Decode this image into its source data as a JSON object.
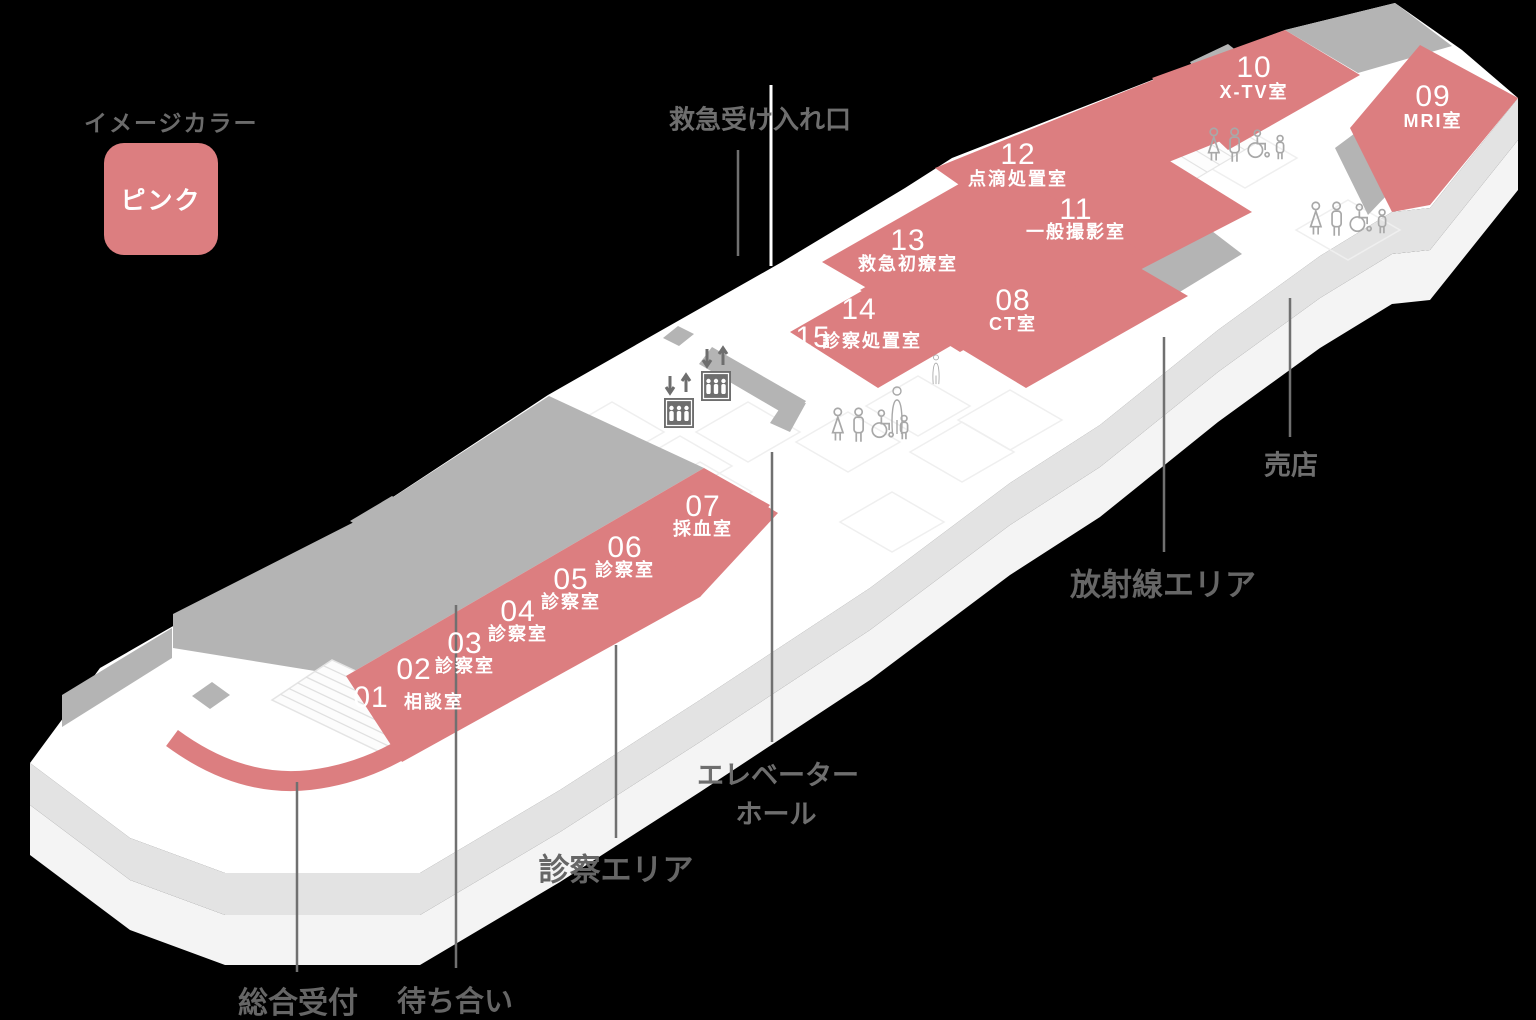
{
  "legend": {
    "title": "イメージカラー",
    "swatch_label": "ピンク"
  },
  "colors": {
    "pink": "#DC7E80",
    "zone_gray": "#B4B4B4",
    "floor_side": "#E3E3E3",
    "floor_side_lower": "#F4F4F4",
    "label_gray": "#666666",
    "icon_gray": "#6E6E6E"
  },
  "labels": {
    "emergency_entrance": "救急受け入れ口",
    "reception": "総合受付",
    "waiting": "待ち合い",
    "exam_area": "診察エリア",
    "elevator_hall_1": "エレベーター",
    "elevator_hall_2": "ホール",
    "radiation_area": "放射線エリア",
    "shop": "売店"
  },
  "rooms": [
    {
      "number": "01",
      "name": "相談室"
    },
    {
      "number": "02",
      "name": ""
    },
    {
      "number": "03",
      "name": "診察室"
    },
    {
      "number": "04",
      "name": "診察室"
    },
    {
      "number": "05",
      "name": "診察室"
    },
    {
      "number": "06",
      "name": "診察室"
    },
    {
      "number": "07",
      "name": "採血室"
    },
    {
      "number": "08",
      "name": "CT室"
    },
    {
      "number": "09",
      "name": "MRI室"
    },
    {
      "number": "10",
      "name": "X-TV室"
    },
    {
      "number": "11",
      "name": "一般撮影室"
    },
    {
      "number": "12",
      "name": "点滴処置室"
    },
    {
      "number": "13",
      "name": "救急初療室"
    },
    {
      "number": "14",
      "name": ""
    },
    {
      "number": "15",
      "name": "診察処置室"
    }
  ],
  "icons": {
    "elevator_arrows": "↓↑",
    "elevator": "elevator-car-with-people",
    "toilet": "restroom-pictograms",
    "person": "standing-person-pictogram"
  }
}
